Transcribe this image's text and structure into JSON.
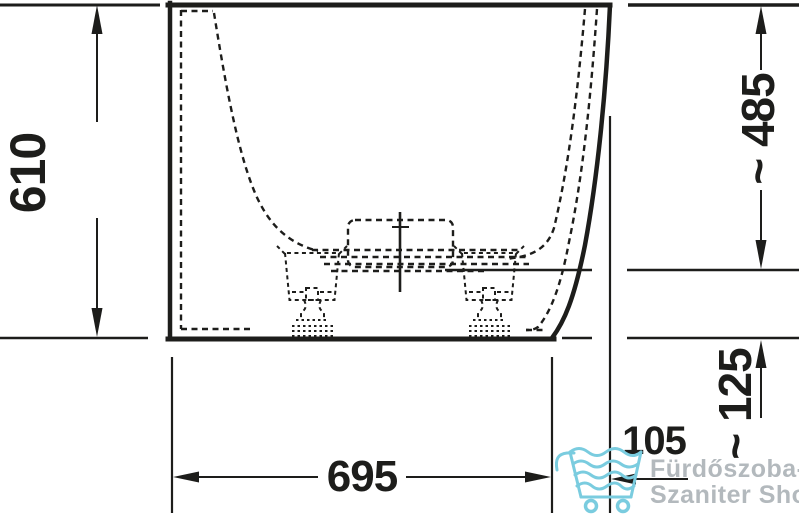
{
  "page": {
    "background": "#ffffff"
  },
  "diagram": {
    "kind": "bathtub-front-elevation-technical-drawing",
    "ink_color": "#1d1d1b",
    "dimensions": {
      "left_vertical": "610",
      "right_upper_vertical": "~ 485",
      "right_lower_vertical": "~ 125",
      "offset_horizontal": "105",
      "bottom_horizontal": "695"
    }
  },
  "watermark": {
    "line1": "Fürdőszoba-",
    "line2": "Szaniter Shop",
    "text_color": "#b3b9bd",
    "icon": "shopping-cart-icon",
    "icon_color": "#7accdf"
  }
}
